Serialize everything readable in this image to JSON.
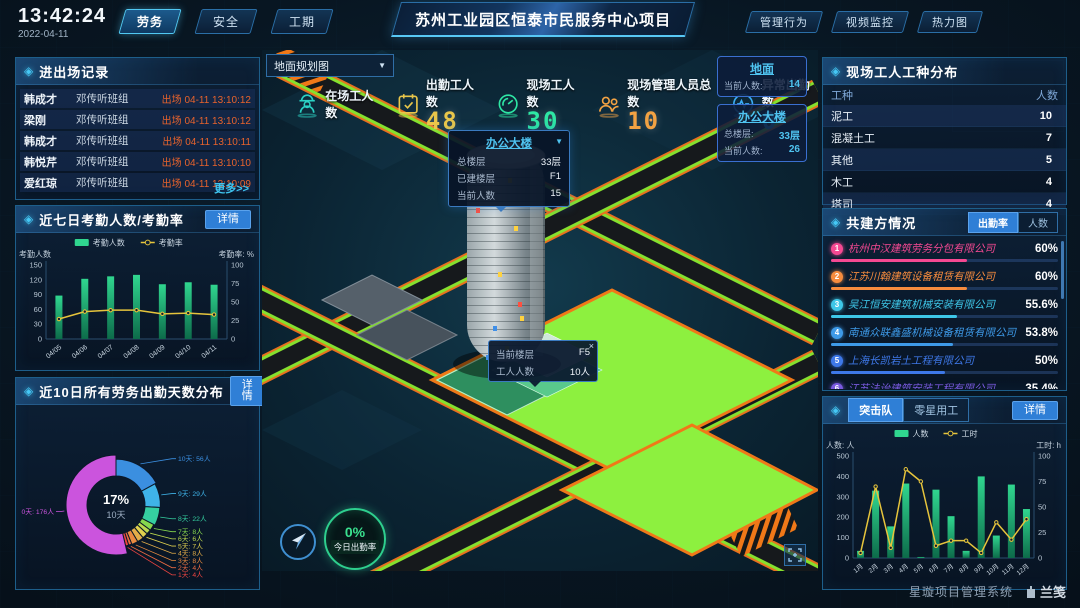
{
  "header": {
    "time": "13:42:24",
    "date": "2022-04-11",
    "tabs": [
      {
        "label": "劳务",
        "active": true
      },
      {
        "label": "安全",
        "active": false
      },
      {
        "label": "工期",
        "active": false
      }
    ],
    "title": "苏州工业园区恒泰市民服务中心项目",
    "right_buttons": [
      {
        "label": "管理行为"
      },
      {
        "label": "视频监控"
      },
      {
        "label": "热力图"
      }
    ]
  },
  "entry_exit": {
    "title": "进出场记录",
    "more_link": "更多>>",
    "rows": [
      {
        "name": "韩成才",
        "group": "邓传听班组",
        "event": "出场 04-11 13:10:12"
      },
      {
        "name": "梁刚",
        "group": "邓传听班组",
        "event": "出场 04-11 13:10:12"
      },
      {
        "name": "韩成才",
        "group": "邓传听班组",
        "event": "出场 04-11 13:10:11"
      },
      {
        "name": "韩悦芹",
        "group": "邓传听班组",
        "event": "出场 04-11 13:10:10"
      },
      {
        "name": "爱红琼",
        "group": "邓传听班组",
        "event": "出场 04-11 13:10:09"
      }
    ]
  },
  "attendance_panel": {
    "title": "近七日考勤人数/考勤率",
    "detail_button": "详情"
  },
  "workdays_panel": {
    "title": "近10日所有劳务出勤天数分布",
    "detail_button": "详情"
  },
  "map": {
    "layer_select": {
      "value": "地面规划图"
    },
    "stats": [
      {
        "label": "在场工人数",
        "value": "",
        "color": "#2bd1c4"
      },
      {
        "label": "出勤工人数",
        "value": "48",
        "color": "#e9c64a"
      },
      {
        "label": "现场工人数",
        "value": "30",
        "color": "#2ee6a4"
      },
      {
        "label": "现场管理人员总数",
        "value": "10",
        "color": "#f2a243"
      },
      {
        "label": "异常出勤数",
        "value": "0",
        "color": "#3badf5"
      }
    ],
    "building_popup": {
      "title": "办公大楼",
      "rows": [
        {
          "label": "总楼层",
          "value": "33层"
        },
        {
          "label": "已建楼层",
          "value": "F1"
        },
        {
          "label": "当前人数",
          "value": "15"
        }
      ]
    },
    "floor_tooltip": {
      "close": "×",
      "rows": [
        {
          "label": "当前楼层",
          "value": "F5"
        },
        {
          "label": "工人人数",
          "value": "10人"
        }
      ]
    },
    "zone_cards": [
      {
        "title": "地面",
        "rows": [
          {
            "label": "当前人数:",
            "value": "14"
          }
        ]
      },
      {
        "title": "办公大楼",
        "rows": [
          {
            "label": "总楼层:",
            "value": "33层"
          },
          {
            "label": "当前人数:",
            "value": "26"
          }
        ]
      }
    ],
    "today_rate": {
      "value": "0%",
      "label": "今日出勤率"
    }
  },
  "worker_types": {
    "title": "现场工人工种分布",
    "columns": [
      "工种",
      "人数"
    ],
    "rows": [
      {
        "type": "泥工",
        "count": "10"
      },
      {
        "type": "混凝土工",
        "count": "7"
      },
      {
        "type": "其他",
        "count": "5"
      },
      {
        "type": "木工",
        "count": "4"
      },
      {
        "type": "塔司",
        "count": "4"
      }
    ]
  },
  "partners": {
    "title": "共建方情况",
    "tabs": [
      {
        "label": "出勤率",
        "active": true
      },
      {
        "label": "人数",
        "active": false
      }
    ],
    "rows": [
      {
        "rank": "1",
        "name": "杭州中汉建筑劳务分包有限公司",
        "value": "60%",
        "color": "#f54992"
      },
      {
        "rank": "2",
        "name": "江苏川翰建筑设备租赁有限公司",
        "value": "60%",
        "color": "#f78c3e"
      },
      {
        "rank": "3",
        "name": "吴江恒安建筑机械安装有限公司",
        "value": "55.6%",
        "color": "#3ec7e8"
      },
      {
        "rank": "4",
        "name": "南通众联鑫盛机械设备租赁有限公司",
        "value": "53.8%",
        "color": "#3e9ae8"
      },
      {
        "rank": "5",
        "name": "上海长凯岩土工程有限公司",
        "value": "50%",
        "color": "#3e78e8"
      },
      {
        "rank": "6",
        "name": "江苏法诒建筑安装工程有限公司",
        "value": "35.4%",
        "color": "#7a5ae0"
      }
    ]
  },
  "squad_panel": {
    "tabs": [
      {
        "label": "突击队",
        "active": true
      },
      {
        "label": "零星用工",
        "active": false
      }
    ],
    "detail_button": "详情"
  },
  "footer": {
    "system_name": "星璇项目管理系统",
    "logo_text": "兰笺"
  },
  "chart_data": [
    {
      "id": "attendance7",
      "type": "bar+line",
      "title": "近七日考勤人数/考勤率",
      "categories": [
        "04/05",
        "04/06",
        "04/07",
        "04/08",
        "04/09",
        "04/10",
        "04/11"
      ],
      "series": [
        {
          "name": "考勤人数",
          "type": "bar",
          "axis": "left",
          "color": "#30d68f",
          "values": [
            88,
            122,
            127,
            130,
            111,
            115,
            110
          ]
        },
        {
          "name": "考勤率",
          "type": "line",
          "axis": "right",
          "color": "#e6c43c",
          "values": [
            27,
            37,
            39,
            39,
            34,
            35,
            33
          ]
        }
      ],
      "left_axis": {
        "label": "考勤人数",
        "min": 0,
        "max": 150,
        "ticks": [
          0,
          30,
          60,
          90,
          120,
          150
        ]
      },
      "right_axis": {
        "label": "考勤率: %",
        "min": 0,
        "max": 100,
        "ticks": [
          0,
          25,
          50,
          75,
          100
        ]
      },
      "legend_position": "top",
      "grid": false
    },
    {
      "id": "workdays10",
      "type": "donut",
      "title": "近10日所有劳务出勤天数分布",
      "center": {
        "percent": "17%",
        "label": "10天"
      },
      "slices": [
        {
          "label": "10天",
          "value": 56,
          "text": "10天: 56人",
          "color": "#3b8fe0"
        },
        {
          "label": "9天",
          "value": 29,
          "text": "9天: 29人",
          "color": "#3fb3e8"
        },
        {
          "label": "8天",
          "value": 22,
          "text": "8天: 22人",
          "color": "#35cfa0"
        },
        {
          "label": "7天",
          "value": 8,
          "text": "7天: 8人",
          "color": "#86d84e"
        },
        {
          "label": "6天",
          "value": 6,
          "text": "6天: 6人",
          "color": "#bcd84e"
        },
        {
          "label": "5天",
          "value": 7,
          "text": "5天: 7人",
          "color": "#e0d04e"
        },
        {
          "label": "4天",
          "value": 8,
          "text": "4天: 8人",
          "color": "#e3ad48"
        },
        {
          "label": "3天",
          "value": 8,
          "text": "3天: 8人",
          "color": "#e88a40"
        },
        {
          "label": "2天",
          "value": 4,
          "text": "2天: 4人",
          "color": "#ea6a42"
        },
        {
          "label": "1天",
          "value": 4,
          "text": "1天: 4人",
          "color": "#ec4440"
        },
        {
          "label": "0天",
          "value": 176,
          "text": "0天: 176人",
          "color": "#cb54dd"
        }
      ]
    },
    {
      "id": "squad",
      "type": "bar+line",
      "title": "突击队",
      "categories": [
        "1月",
        "2月",
        "3月",
        "4月",
        "5月",
        "6月",
        "7月",
        "8月",
        "9月",
        "10月",
        "11月",
        "12月"
      ],
      "series": [
        {
          "name": "人数",
          "type": "bar",
          "axis": "left",
          "color": "#30d68f",
          "values": [
            35,
            330,
            155,
            365,
            5,
            335,
            205,
            35,
            400,
            110,
            360,
            240
          ]
        },
        {
          "name": "工时",
          "type": "line",
          "axis": "right",
          "color": "#e6c43c",
          "values": [
            5,
            70,
            10,
            87,
            75,
            12,
            17,
            17,
            5,
            35,
            18,
            38
          ]
        }
      ],
      "left_axis": {
        "label": "人数: 人",
        "min": 0,
        "max": 500,
        "ticks": [
          0,
          100,
          200,
          300,
          400,
          500
        ]
      },
      "right_axis": {
        "label": "工时: h",
        "min": 0,
        "max": 100,
        "ticks": [
          0,
          25,
          50,
          75,
          100
        ]
      },
      "legend_position": "top",
      "grid": false
    }
  ]
}
